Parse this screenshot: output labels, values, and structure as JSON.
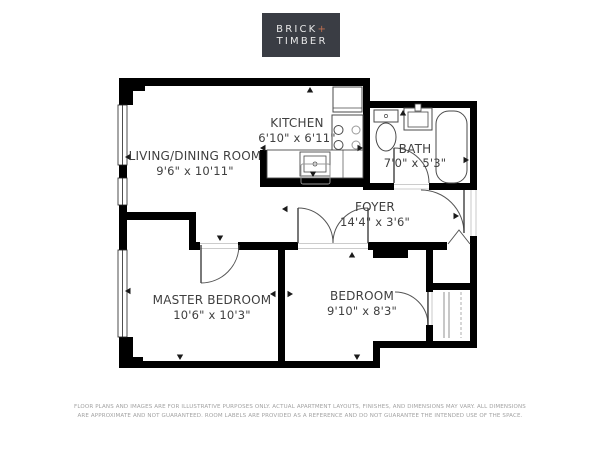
{
  "logo": {
    "line1": "BRICK",
    "plus": "+",
    "line2": "TIMBER",
    "bg_color": "#3a3d44",
    "text_color": "#e8e8e8",
    "plus_color": "#bf6f50"
  },
  "rooms": [
    {
      "name": "LIVING/DINING ROOM",
      "dimensions": "9'6\" x 10'11\""
    },
    {
      "name": "KITCHEN",
      "dimensions": "6'10\" x 6'11\""
    },
    {
      "name": "BATH",
      "dimensions": "7'0\" x 5'3\""
    },
    {
      "name": "FOYER",
      "dimensions": "14'4\" x 3'6\""
    },
    {
      "name": "MASTER BEDROOM",
      "dimensions": "10'6\" x 10'3\""
    },
    {
      "name": "BEDROOM",
      "dimensions": "9'10\" x 8'3\""
    }
  ],
  "disclaimer": {
    "line1": "FLOOR PLANS AND IMAGES ARE FOR ILLUSTRATIVE PURPOSES ONLY. ACTUAL APARTMENT LAYOUTS, FINISHES, AND DIMENSIONS MAY VARY. ALL DIMENSIONS",
    "line2": "ARE APPROXIMATE AND NOT GUARANTEED. ROOM LABELS ARE PROVIDED AS A REFERENCE AND DO NOT GUARANTEE THE INTENDED USE OF THE SPACE."
  },
  "colors": {
    "wall": "#000000",
    "label_text": "#3f3f3f",
    "disclaimer_text": "#a2a2a2"
  }
}
